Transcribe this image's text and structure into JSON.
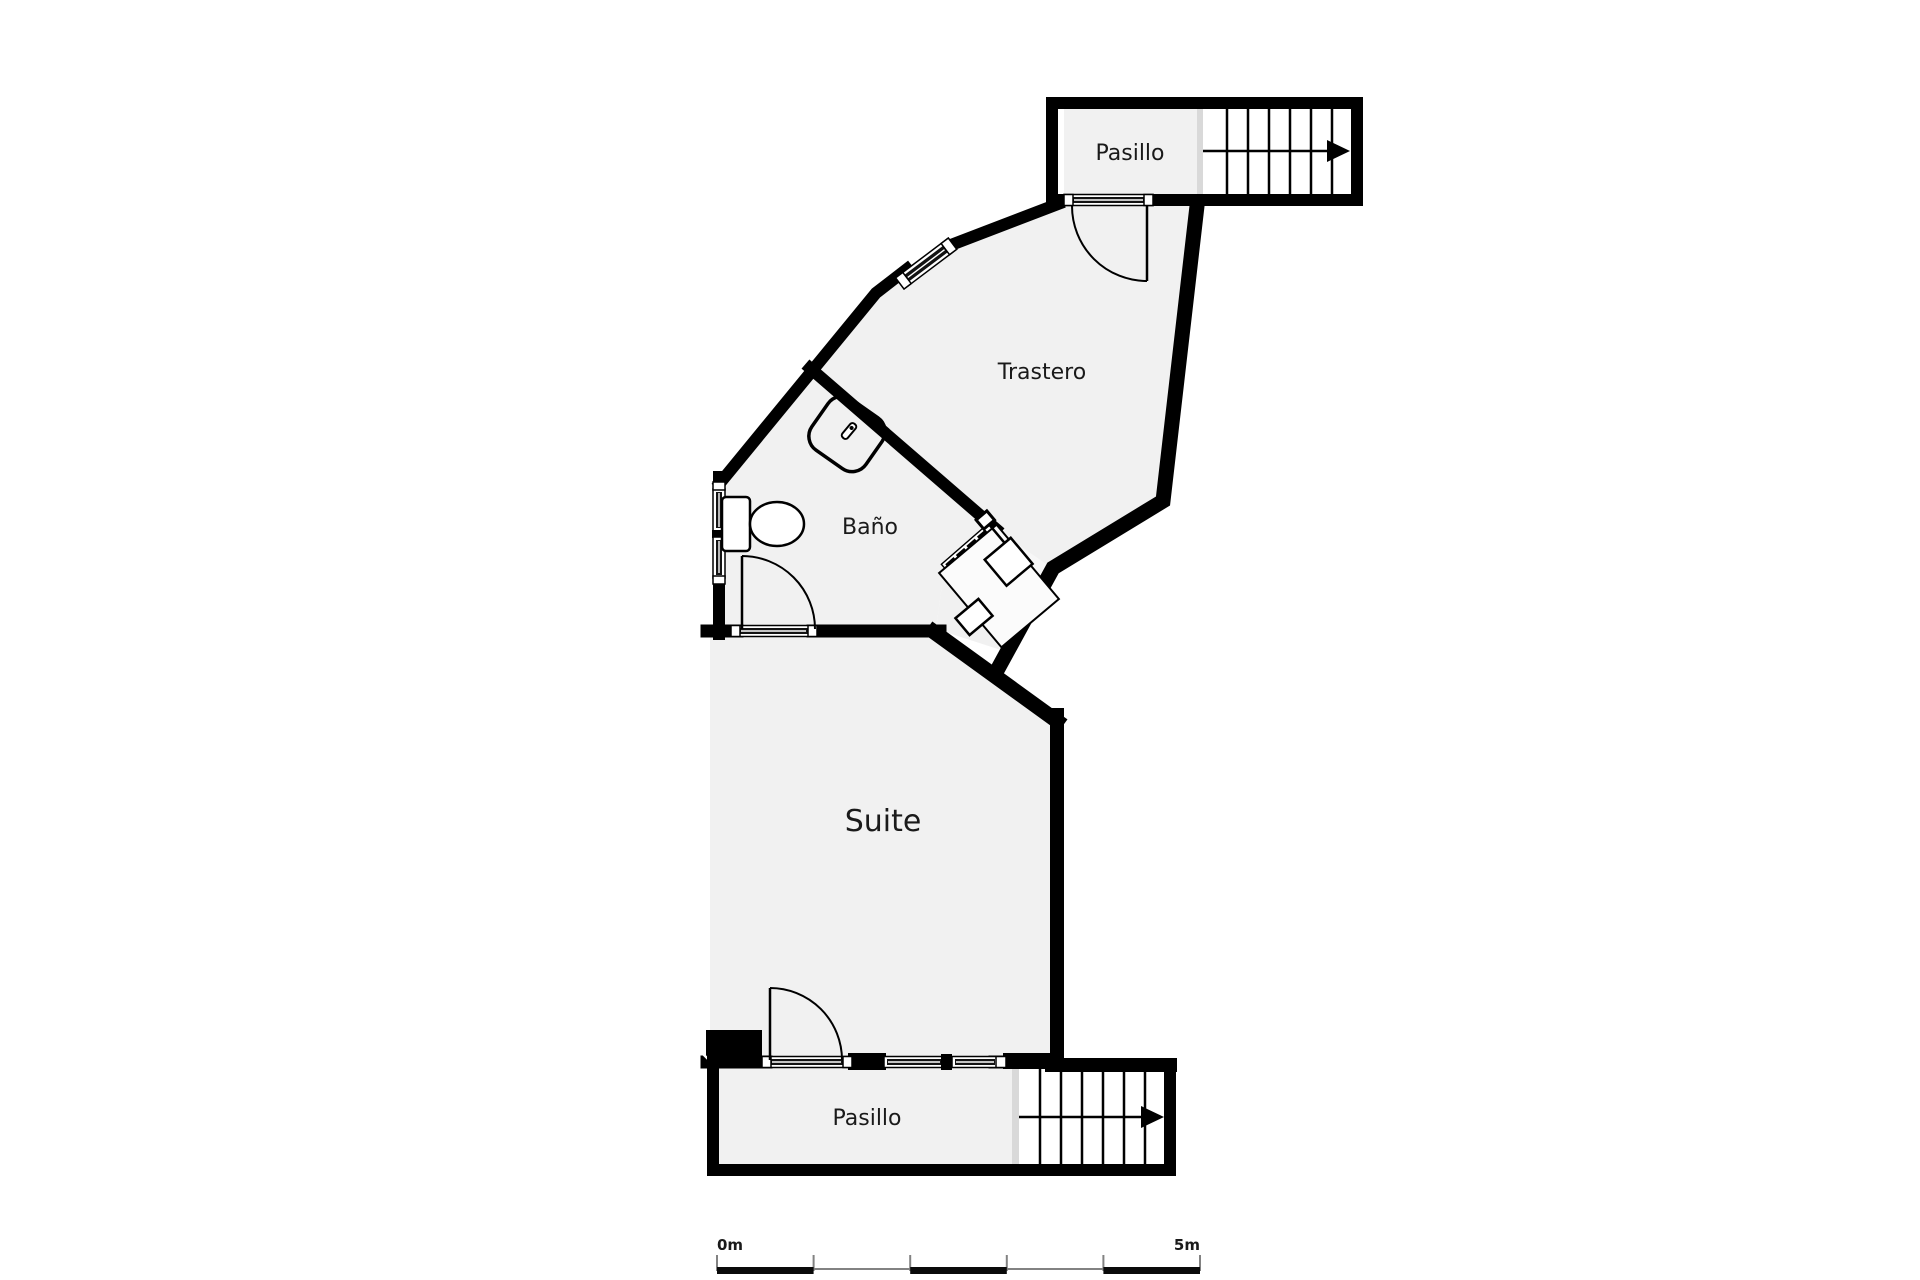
{
  "plan": {
    "type": "floor-plan",
    "rooms": {
      "pasillo_top": {
        "label": "Pasillo"
      },
      "trastero": {
        "label": "Trastero"
      },
      "bano": {
        "label": "Baño"
      },
      "suite": {
        "label": "Suite"
      },
      "pasillo_bottom": {
        "label": "Pasillo"
      }
    },
    "stairs": {
      "count": 2,
      "direction_icon": "right-arrow",
      "treads_per_flight": 7
    },
    "fixtures": [
      "toilet",
      "shower-tray",
      "sink-counter",
      "sink",
      "tap",
      "radiator"
    ],
    "scale_bar": {
      "start": "0m",
      "end": "5m",
      "segments": 5
    },
    "colors": {
      "wall": "#000000",
      "floor": "#f1f1f1",
      "stairs_floor": "#ffffff",
      "divider": "#d9d9d9",
      "background": "#ffffff",
      "text": "#1a1a1a"
    }
  }
}
